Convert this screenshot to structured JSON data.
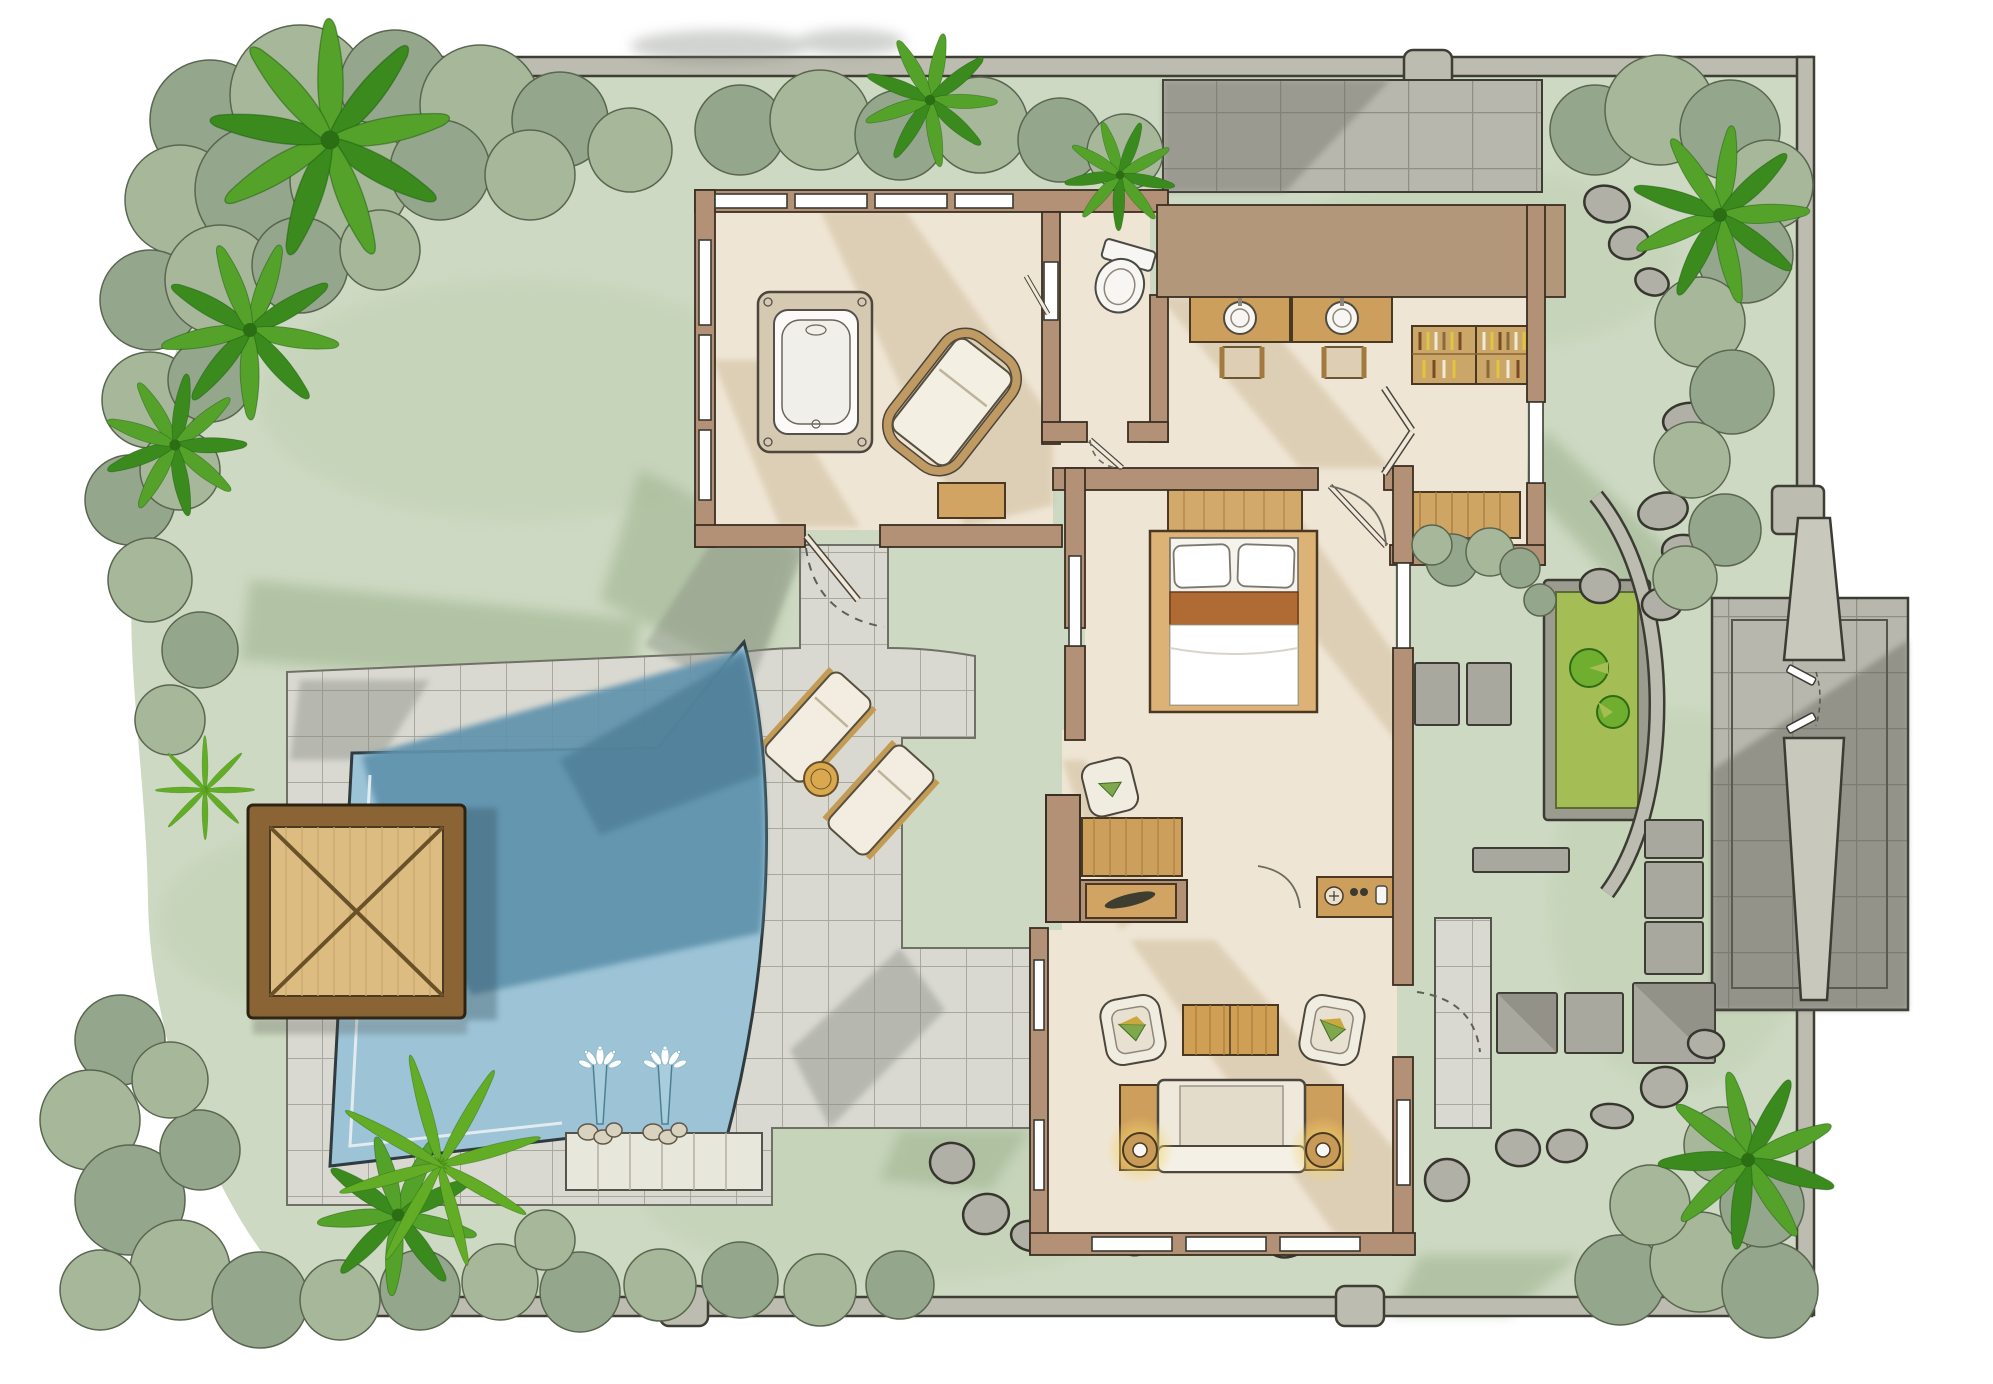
{
  "meta": {
    "kind": "hand-rendered villa site / floor plan illustration",
    "canvas": {
      "width": 1993,
      "height": 1384
    },
    "orientation": "top-down plan view, no text labels rendered"
  },
  "palette": {
    "paper": "#ffffff",
    "lawn": "#cdd9c2",
    "lawn_shade": "#aebfa0",
    "foliage": "#94a78c",
    "foliage_light": "#a6b899",
    "palm": "#55a22a",
    "palm_dark": "#3a8a1d",
    "fern": "#62ad25",
    "boundary_wall": "#bcbcb0",
    "house_wall": "#b29176",
    "floor": "#efe5d4",
    "patio_tile": "#d9d9d1",
    "court_tile": "#b7b7ad",
    "pool_light": "#9cc3d6",
    "pool_dark": "#6093ad",
    "ledge": "#e8e7dc",
    "wood": "#d2a464",
    "wood_light": "#ddbc82",
    "wood_dark": "#8a6434",
    "bed_runner": "#b06a33",
    "white_fixture": "#f7f6f2",
    "stone": "#b0b0a6",
    "pond": "#a4bd55",
    "lily_pad": "#6fae2e",
    "lamp_glow": "#f3d169",
    "cushion_green": "#7fa84d",
    "cushion_yellow": "#c9a93f"
  },
  "features": {
    "boundary": {
      "walls": [
        "top",
        "right",
        "bottom"
      ],
      "posts": 6
    },
    "pool": {
      "fountain_jets": 2,
      "swim_ledge": true,
      "deep_end_shaded": true
    },
    "gazebo": {
      "type": "timber deck pavilion",
      "roof": "X-braced"
    },
    "sun_deck": {
      "loungers": 2,
      "round_side_table": 1
    },
    "bathroom": {
      "bathtub": 1,
      "chaise_lounge": 1,
      "toilet": 1,
      "vanity_sinks": 2,
      "stools": 2,
      "wardrobe": 1,
      "bench": 1
    },
    "hall": {
      "double_doors": 1,
      "benches": 1
    },
    "bedroom": {
      "bed": 1,
      "pillows": 2,
      "headboard_bench": 1,
      "desk": 1,
      "desk_chair": 1,
      "leaf_bench": 1,
      "minibar_console": 1
    },
    "living_pavilion": {
      "sofa": 1,
      "armchairs": 2,
      "coffee_table": 1,
      "table_lamps": 2,
      "side_porch": 1
    },
    "entry": {
      "parking_court": 1,
      "entry_court": 1,
      "gate_pillars": 2,
      "gate_doors": 2,
      "lily_pond": {
        "lily_pads": 2
      },
      "curved_wall": 1
    },
    "landscape": {
      "palm_trees": 7,
      "ferns": 2,
      "stepping_stones": 25,
      "square_pavers": 9
    }
  }
}
